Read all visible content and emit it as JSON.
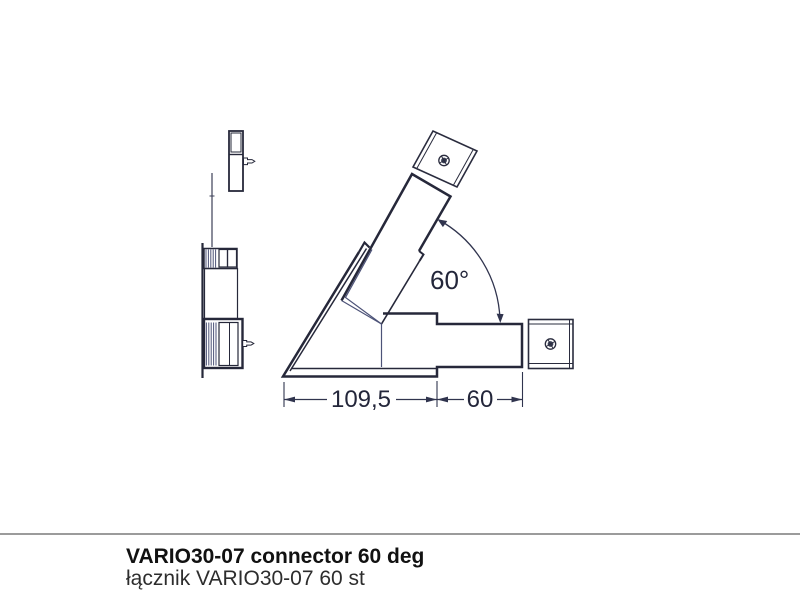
{
  "drawing": {
    "angle_label": "60°",
    "dim_overall": "109,5",
    "dim_connector": "60"
  },
  "footer": {
    "title_en": "VARIO30-07 connector 60 deg",
    "title_pl": "łącznik VARIO30-07 60 st"
  },
  "colors": {
    "line_dark": "#26283a",
    "line_thin_blue": "#4d5378",
    "dimension": "#30344e",
    "divider": "#9b9b9b",
    "background": "#ffffff"
  }
}
